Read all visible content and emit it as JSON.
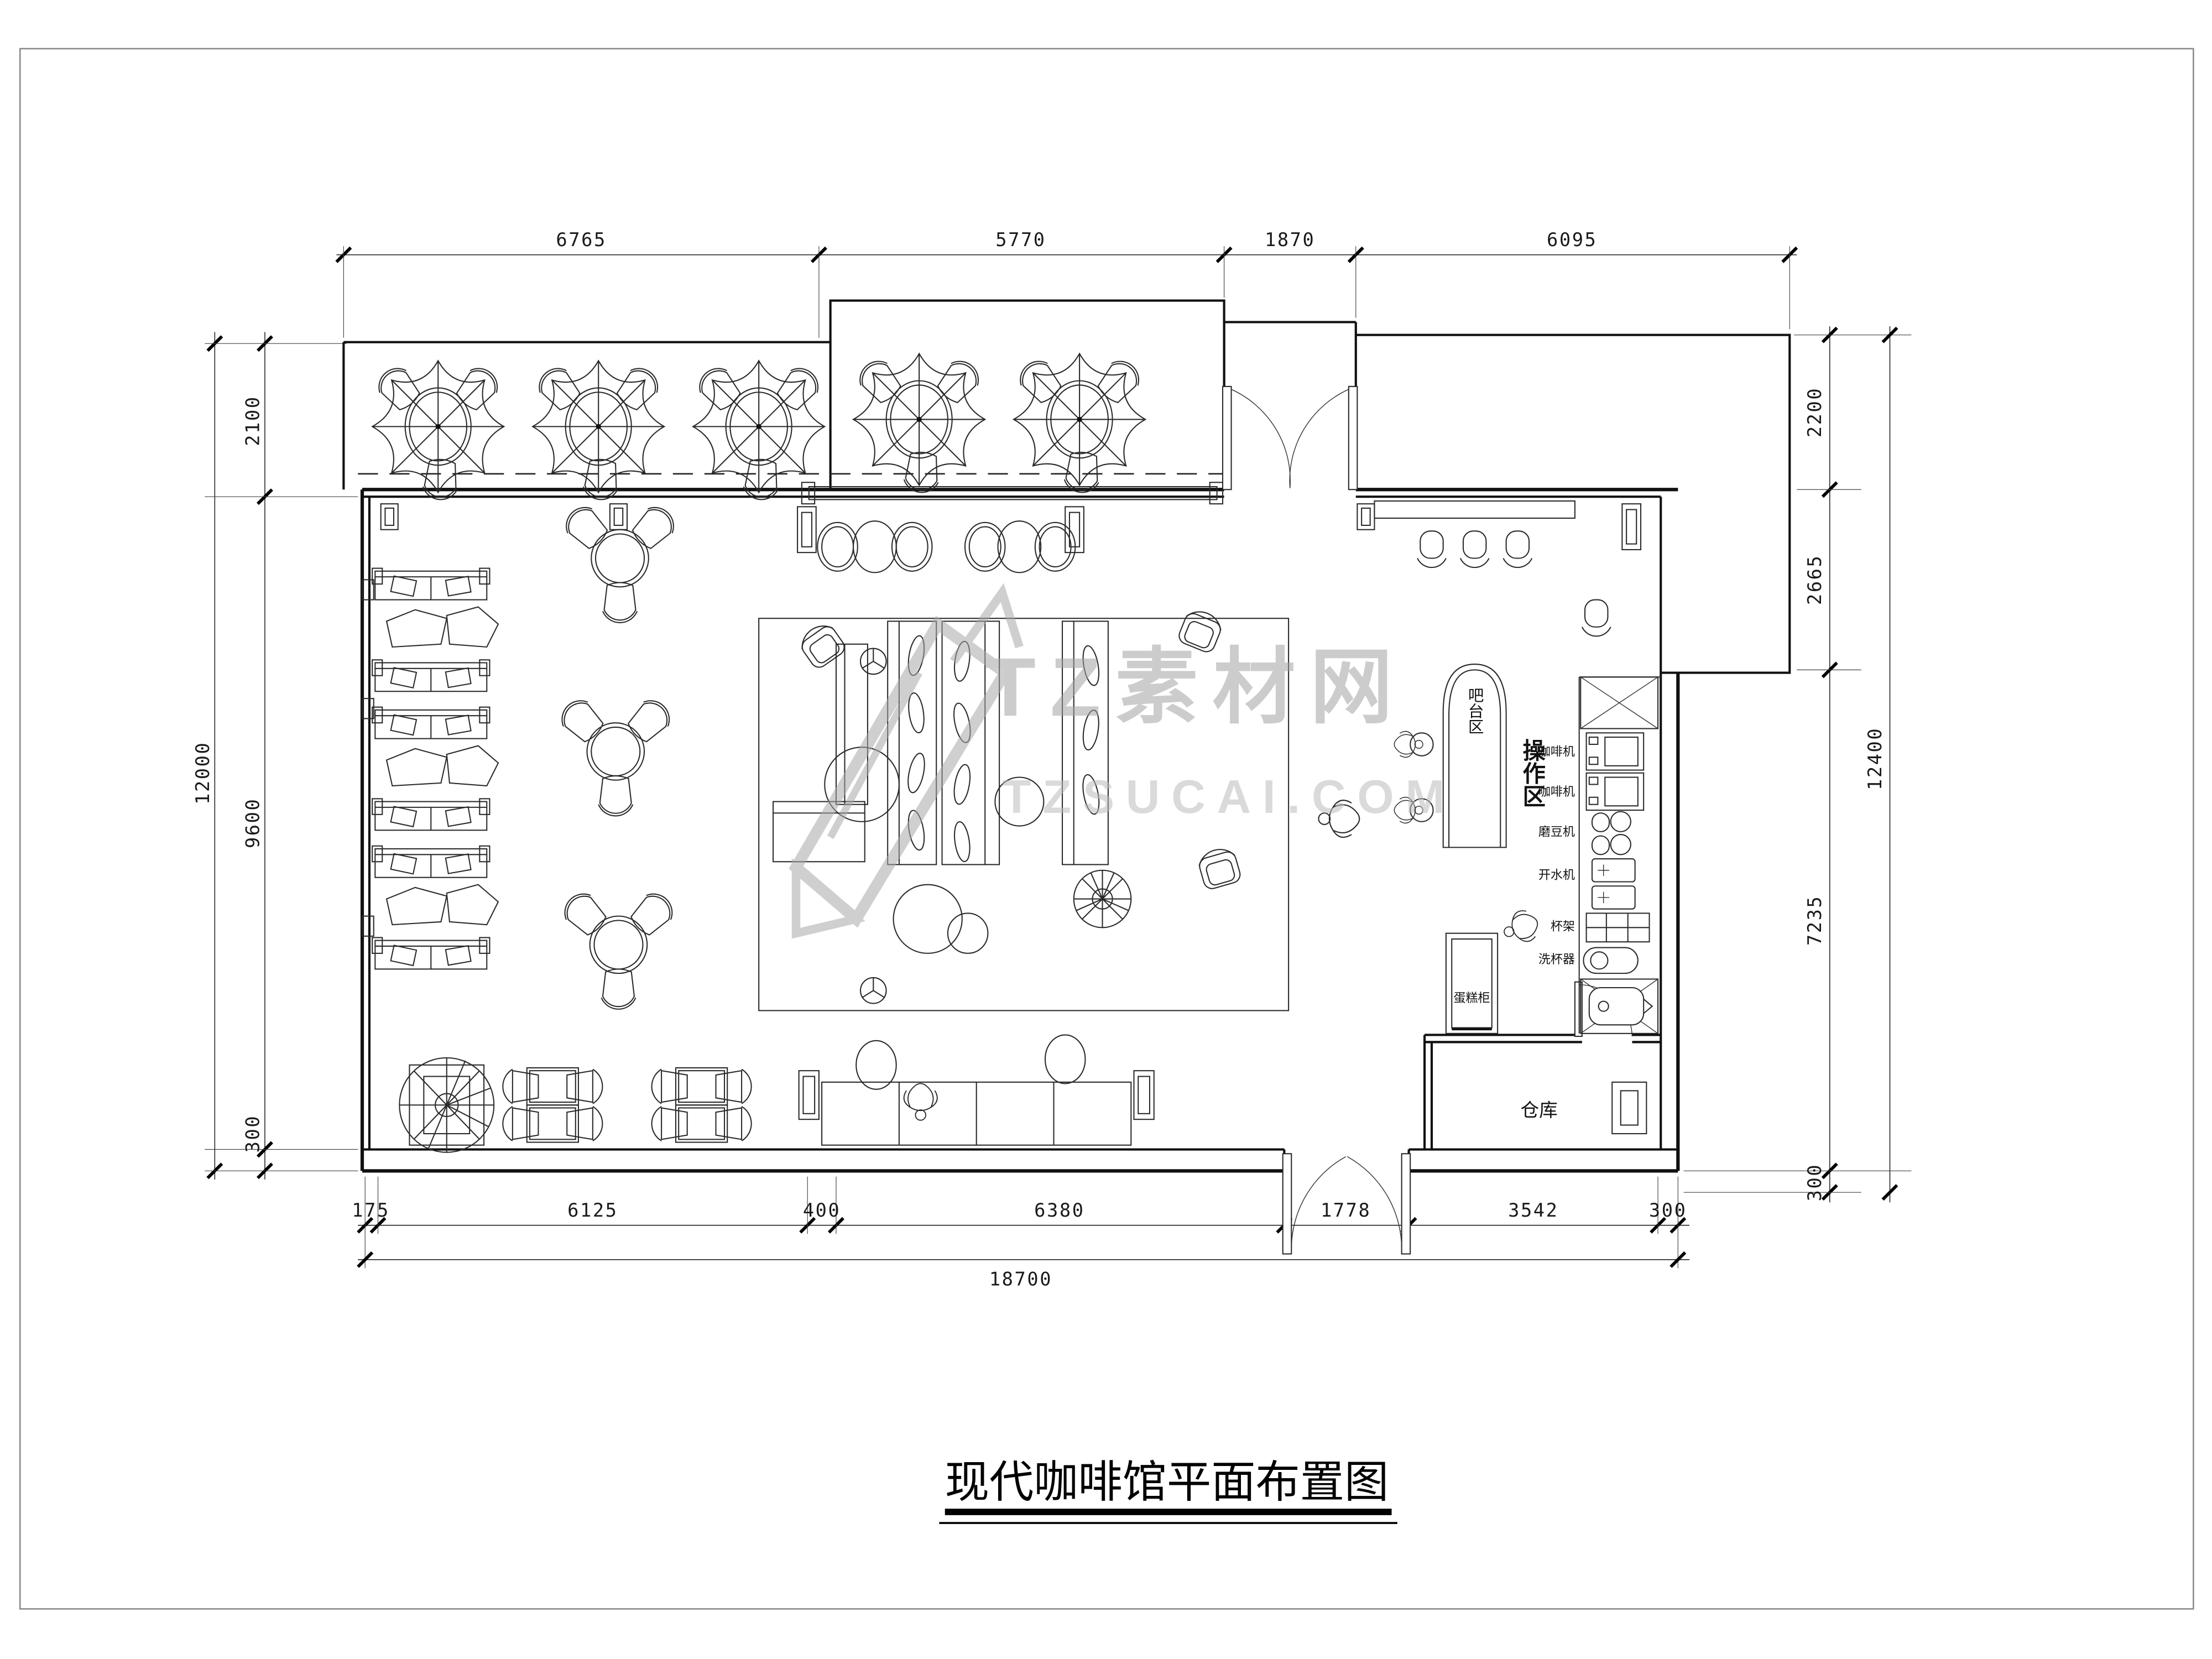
{
  "drawing": {
    "title": "现代咖啡馆平面布置图",
    "watermark": {
      "brand": "TZ素材网",
      "domain": "TZSUCAI.COM"
    },
    "dims": {
      "top": [
        "6765",
        "5770",
        "1870",
        "6095"
      ],
      "left_outer": "12000",
      "left_inner": [
        "2100",
        "9600",
        "300"
      ],
      "right_outer": "12400",
      "right_inner": [
        "2200",
        "2665",
        "7235",
        "300"
      ],
      "bottom_row": [
        "175",
        "6125",
        "400",
        "6380",
        "1778",
        "3542",
        "300"
      ],
      "bottom_total": "18700"
    },
    "labels": {
      "bar_area": "吧台区",
      "operation_area": "操作区",
      "warehouse": "仓库",
      "cake_cabinet": "蛋糕柜",
      "equipment": [
        "咖啡机",
        "咖啡机",
        "磨豆机",
        "开水机",
        "杯架",
        "洗杯器"
      ]
    }
  }
}
